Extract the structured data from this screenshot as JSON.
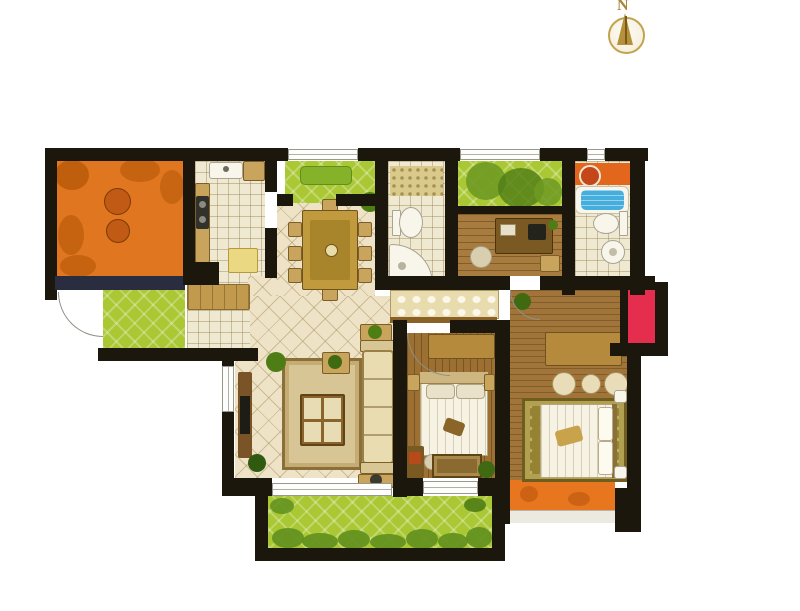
{
  "compass": {
    "label": "N"
  },
  "plan_type": "apartment-floor-plan",
  "rooms": [
    {
      "id": "terrace-balcony"
    },
    {
      "id": "kitchen"
    },
    {
      "id": "dining-room"
    },
    {
      "id": "dining-balcony"
    },
    {
      "id": "guest-bathroom"
    },
    {
      "id": "garden-balcony"
    },
    {
      "id": "study"
    },
    {
      "id": "master-bathroom"
    },
    {
      "id": "service-balcony"
    },
    {
      "id": "entry"
    },
    {
      "id": "flower-bed"
    },
    {
      "id": "hallway"
    },
    {
      "id": "living-room"
    },
    {
      "id": "second-bedroom"
    },
    {
      "id": "master-bedroom"
    },
    {
      "id": "master-balcony"
    },
    {
      "id": "south-balcony"
    }
  ],
  "colors": {
    "wall": "#1b170c",
    "terrace": "#e0761f",
    "terraceLeaf": "#b45708",
    "green": "#a9c834",
    "hedge": "#5f8f1d",
    "tile": "#eee3c6",
    "grid": "#efe9d2",
    "woodStudy": "#a87c3e",
    "woodBedroom": "#9c7033",
    "woodMaster": "#a1753a",
    "woodHall": "#8a6228",
    "red": "#e52e4e",
    "tub": "#46aedc",
    "counterOrange": "#e2661c",
    "balconyOrange": "#e8761e",
    "navyRail": "#2a2d3f",
    "furnitureTan": "#c8a45c",
    "gold": "#c09a3c",
    "compassGold": "#b6913c"
  }
}
